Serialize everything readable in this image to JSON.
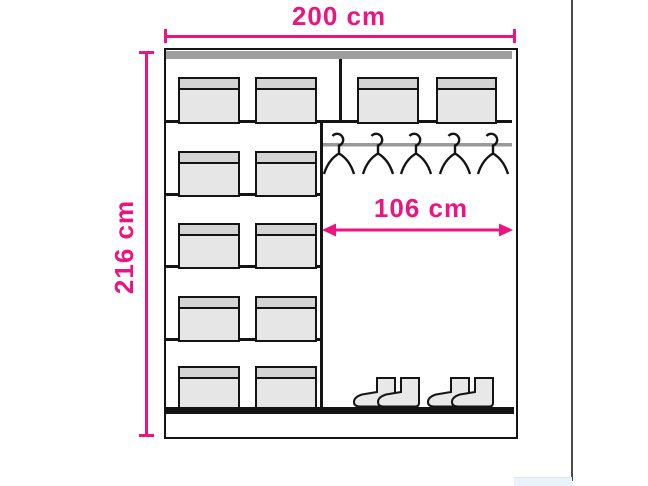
{
  "title": "Wardrobe internal layout dimension diagram",
  "dimensions": {
    "width": "200 cm",
    "height": "216 cm",
    "hanging_width": "106 cm"
  },
  "colors": {
    "accent": "#ec1481",
    "outline": "#141414",
    "top_panel": "#9e9e9e",
    "rail": "#999999",
    "box_fill": "#e6e6e6",
    "box_lid": "#d4d4d4",
    "boot_fill": "#e8e8e8",
    "artifact_line": "#4b4b4b"
  },
  "sections": {
    "top_shelf": {
      "left_box_count": 2,
      "right_box_count": 2
    },
    "left_column": {
      "row_count": 4,
      "boxes_per_row": 2
    },
    "hanging": {
      "hanger_count": 5,
      "boot_pair_count": 2
    }
  }
}
